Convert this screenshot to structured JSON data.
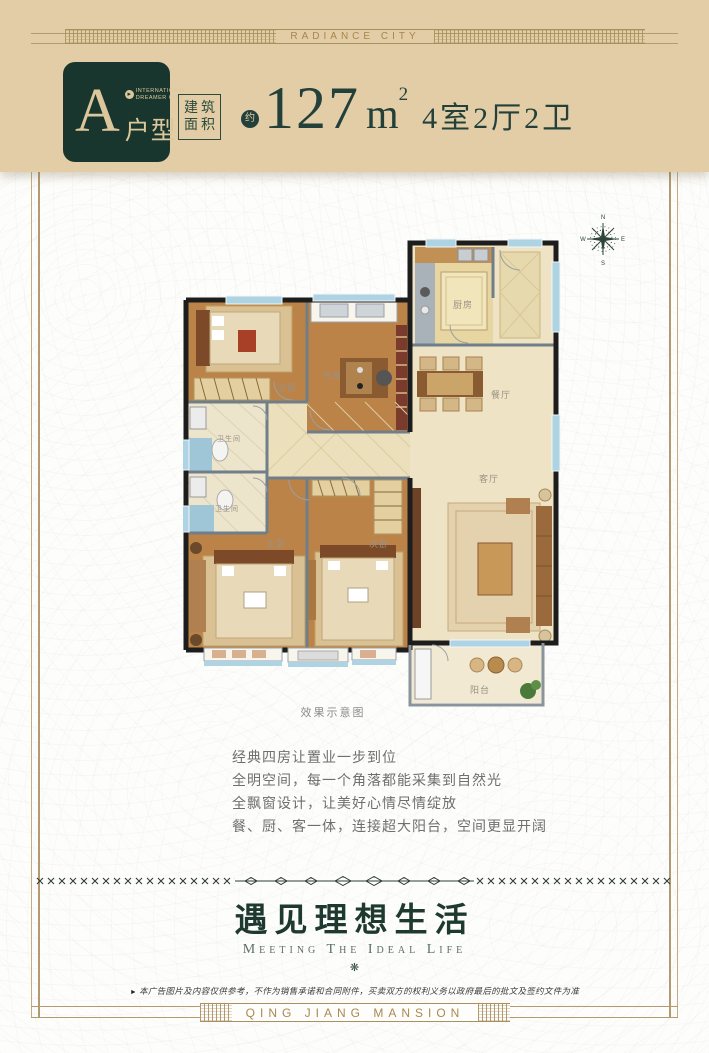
{
  "header": {
    "band_text": "RADIANCE CITY",
    "badge": {
      "letter": "A",
      "brand_line1": "INTERNATIONAL",
      "brand_line2": "DREAMER CITY",
      "type_label": "户型"
    },
    "area_box_line1": "建筑",
    "area_box_line2": "面积",
    "approx_label": "约",
    "area_value": "127",
    "area_unit_base": "m",
    "area_unit_sup": "2",
    "spec": "4室2厅2卫"
  },
  "compass": {
    "n": "N",
    "e": "E",
    "s": "S",
    "w": "W"
  },
  "floorplan": {
    "caption": "效果示意图",
    "rooms": {
      "kitchen": "厨房",
      "dining": "餐厅",
      "living": "客厅",
      "balcony": "阳台",
      "study": "书房",
      "bedroom_top": "次卧",
      "bedroom_bottom": "次卧",
      "master": "主卧",
      "bath1": "卫生间",
      "bath2": "卫生间"
    }
  },
  "features": {
    "lines": [
      "经典四房让置业一步到位",
      "全明空间，每一个角落都能采集到自然光",
      "全飘窗设计，让美好心情尽情绽放",
      "餐、厨、客一体，连接超大阳台，空间更显开阔"
    ]
  },
  "slogan": {
    "title": "遇见理想生活",
    "subtitle": "Meeting The Ideal Life"
  },
  "icons": {
    "badge_arrow": "▸",
    "ornament": "❋",
    "disclaimer_marker": "►"
  },
  "disclaimer": {
    "text": "本广告图片及内容仅供参考，不作为销售承诺和合同附件，买卖双方的权利义务以政府最后的批文及签约文件为准"
  },
  "footer": {
    "band_text": "QING JIANG MANSION"
  },
  "colors": {
    "header_bg": "#e2cda6",
    "brand_green": "#23413a",
    "gold": "#ab8850",
    "frame": "#b39a70",
    "wood_floor": "#bc8348",
    "tile_floor": "#eee3c4",
    "window_blue": "#aed3e3"
  }
}
